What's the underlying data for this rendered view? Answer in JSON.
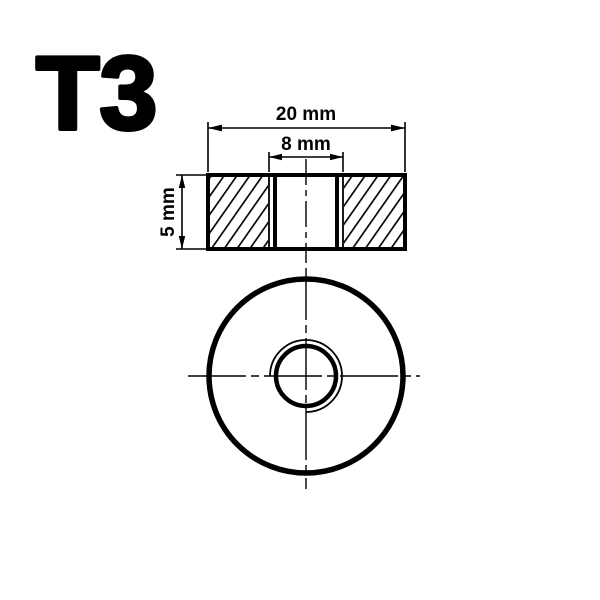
{
  "drawing": {
    "part_label": "T3",
    "dimensions": {
      "outer_width": "20 mm",
      "hole_width": "8 mm",
      "thickness": "5 mm"
    },
    "colors": {
      "line": "#000000",
      "background": "#ffffff"
    },
    "views": {
      "section": "cross-section-view",
      "front": "front-view"
    }
  }
}
